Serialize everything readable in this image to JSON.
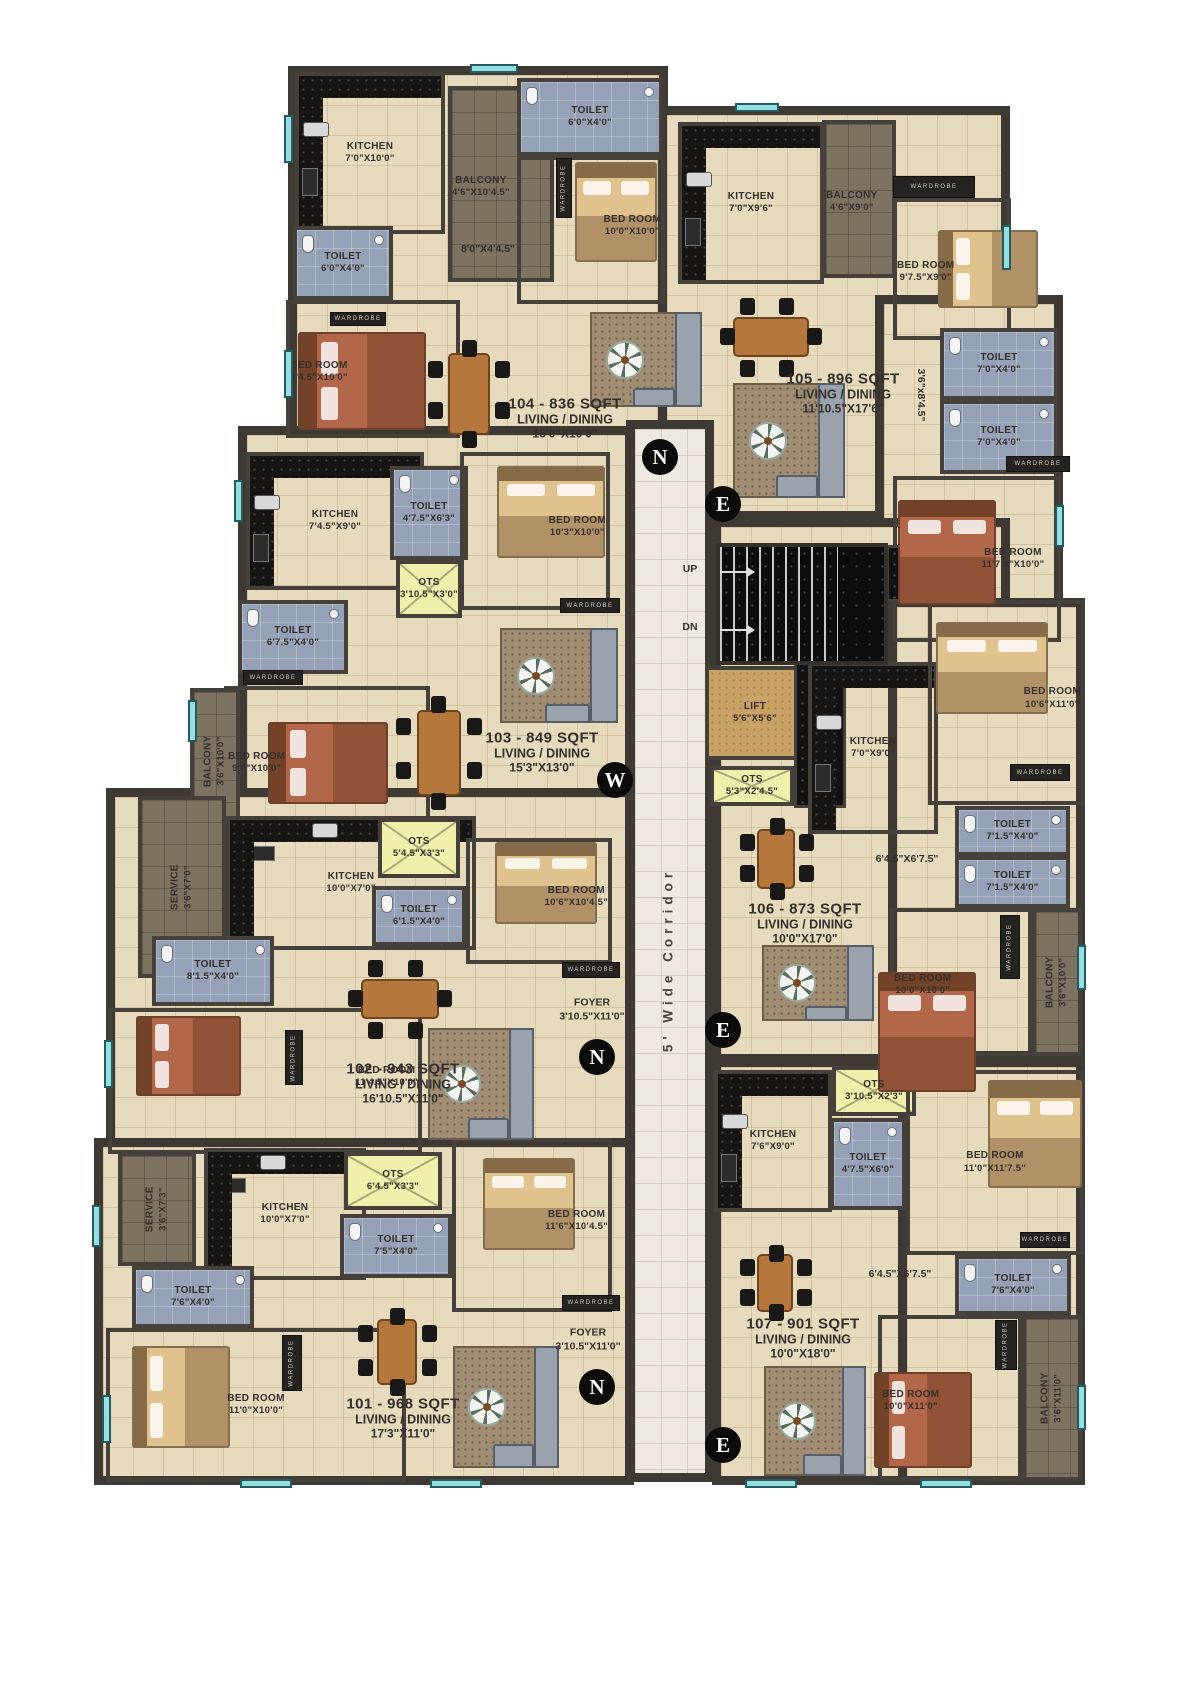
{
  "colors": {
    "wall": "#3e3933",
    "floor": "#e8dabd",
    "toilet": "#95a1b6",
    "balcony": "#7e7260",
    "ots": "#eff0ac",
    "lift": "#c9a265",
    "corridor": "#eee9e1",
    "stairs": "#0e0d0c",
    "window": "#9adde0"
  },
  "wardrobe_text": "WARDROBE",
  "corridor_label": "5' Wide Corridor",
  "regions": [
    {
      "x": 288,
      "y": 66,
      "w": 380,
      "h": 374
    },
    {
      "x": 658,
      "y": 106,
      "w": 352,
      "h": 414
    },
    {
      "x": 875,
      "y": 295,
      "w": 188,
      "h": 350
    },
    {
      "x": 238,
      "y": 426,
      "w": 396,
      "h": 412
    },
    {
      "x": 106,
      "y": 788,
      "w": 528,
      "h": 370
    },
    {
      "x": 94,
      "y": 1138,
      "w": 540,
      "h": 347
    },
    {
      "x": 712,
      "y": 518,
      "w": 298,
      "h": 545
    },
    {
      "x": 888,
      "y": 598,
      "w": 197,
      "h": 462
    },
    {
      "x": 712,
      "y": 1058,
      "w": 312,
      "h": 427
    },
    {
      "x": 898,
      "y": 1058,
      "w": 187,
      "h": 427
    }
  ],
  "corridor": {
    "x": 626,
    "y": 420,
    "w": 88,
    "h": 1062
  },
  "stairs": {
    "x": 716,
    "y": 543,
    "w": 172,
    "h": 122,
    "treads_w": 118,
    "up": "UP",
    "dn": "DN"
  },
  "rooms": [
    {
      "t": "kitchen",
      "x": 295,
      "y": 72,
      "w": 150,
      "h": 162,
      "label": "KITCHEN",
      "dims": "7'0\"X10'0\"",
      "counter": "left,top"
    },
    {
      "t": "balcony",
      "x": 448,
      "y": 86,
      "w": 106,
      "h": 196,
      "label": "BALCONY",
      "dims": "4'6\"X10'4.5\"",
      "lp": "top"
    },
    {
      "t": "toilet",
      "x": 517,
      "y": 78,
      "w": 146,
      "h": 78,
      "label": "TOILET",
      "dims": "6'0\"X4'0\""
    },
    {
      "t": "floor",
      "x": 517,
      "y": 156,
      "w": 148,
      "h": 148,
      "label": "BED ROOM",
      "dims": "10'0\"X10'0\"",
      "lp": "bottom"
    },
    {
      "t": "toilet",
      "x": 293,
      "y": 226,
      "w": 100,
      "h": 74,
      "label": "TOILET",
      "dims": "6'0\"X4'0\""
    },
    {
      "t": "floor",
      "x": 286,
      "y": 300,
      "w": 174,
      "h": 138,
      "label": "BED ROOM",
      "dims": "9'4.5\"X10'0\"",
      "lp": "top"
    },
    {
      "t": "kitchen",
      "x": 678,
      "y": 122,
      "w": 146,
      "h": 162,
      "label": "KITCHEN",
      "dims": "7'0\"X9'6\"",
      "counter": "left,top"
    },
    {
      "t": "balcony",
      "x": 822,
      "y": 120,
      "w": 74,
      "h": 158,
      "label": "BALCONY",
      "dims": "4'6\"X9'0\"",
      "lp": "top"
    },
    {
      "t": "floor",
      "x": 893,
      "y": 198,
      "w": 118,
      "h": 142,
      "label": "BED ROOM",
      "dims": "9'7.5\"X9'0\"",
      "lp": "top"
    },
    {
      "t": "toilet",
      "x": 940,
      "y": 328,
      "w": 118,
      "h": 72,
      "label": "TOILET",
      "dims": "7'0\"X4'0\""
    },
    {
      "t": "toilet",
      "x": 940,
      "y": 400,
      "w": 118,
      "h": 74,
      "label": "TOILET",
      "dims": "7'0\"X4'0\""
    },
    {
      "t": "floor",
      "x": 893,
      "y": 476,
      "w": 168,
      "h": 166,
      "label": "BED ROOM",
      "dims": "11'7.5\"X10'0\"",
      "lp": "right"
    },
    {
      "t": "lift",
      "x": 705,
      "y": 666,
      "w": 100,
      "h": 94,
      "label": "LIFT",
      "dims": "5'6\"X5'6\""
    },
    {
      "t": "ots",
      "x": 710,
      "y": 766,
      "w": 84,
      "h": 40,
      "label": "OTS",
      "dims": "5'3\"X2'4.5\""
    },
    {
      "t": "shaft",
      "x": 794,
      "y": 662,
      "w": 52,
      "h": 146
    },
    {
      "t": "shaft",
      "x": 886,
      "y": 545,
      "w": 100,
      "h": 57
    },
    {
      "t": "kitchen",
      "x": 808,
      "y": 662,
      "w": 130,
      "h": 172,
      "label": "KITCHEN",
      "dims": "7'0\"X9'0\"",
      "counter": "left,top"
    },
    {
      "t": "floor",
      "x": 928,
      "y": 600,
      "w": 157,
      "h": 205,
      "label": "BED ROOM",
      "dims": "10'6\"X11'0\"",
      "lp": "bottom"
    },
    {
      "t": "toilet",
      "x": 955,
      "y": 806,
      "w": 115,
      "h": 50,
      "label": "TOILET",
      "dims": "7'1.5\"X4'0\""
    },
    {
      "t": "toilet",
      "x": 955,
      "y": 856,
      "w": 115,
      "h": 52,
      "label": "TOILET",
      "dims": "7'1.5\"X4'0\""
    },
    {
      "t": "floor",
      "x": 890,
      "y": 908,
      "w": 142,
      "h": 148,
      "label": "BED ROOM",
      "dims": "10'0\"X10'0\"",
      "lp": "top"
    },
    {
      "t": "balcony",
      "x": 1032,
      "y": 908,
      "w": 50,
      "h": 148,
      "label": "BALCONY",
      "dims": "3'6\"X10'0\"",
      "vertical": true
    },
    {
      "t": "kitchen",
      "x": 714,
      "y": 1070,
      "w": 118,
      "h": 142,
      "label": "KITCHEN",
      "dims": "7'6\"X9'0\"",
      "counter": "left,top"
    },
    {
      "t": "ots",
      "x": 832,
      "y": 1066,
      "w": 84,
      "h": 50,
      "label": "OTS",
      "dims": "3'10.5\"X2'3\""
    },
    {
      "t": "toilet",
      "x": 830,
      "y": 1118,
      "w": 76,
      "h": 92,
      "label": "TOILET",
      "dims": "4'7.5\"X6'0\""
    },
    {
      "t": "floor",
      "x": 906,
      "y": 1070,
      "w": 178,
      "h": 185,
      "label": "BED ROOM",
      "dims": "11'0\"X11'7.5\"",
      "lp": "center"
    },
    {
      "t": "toilet",
      "x": 955,
      "y": 1255,
      "w": 116,
      "h": 60,
      "label": "TOILET",
      "dims": "7'6\"X4'0\""
    },
    {
      "t": "floor",
      "x": 878,
      "y": 1315,
      "w": 144,
      "h": 166,
      "label": "BED ROOM",
      "dims": "10'0\"X11'0\"",
      "lp": "top"
    },
    {
      "t": "balcony",
      "x": 1022,
      "y": 1315,
      "w": 60,
      "h": 166,
      "label": "BALCONY",
      "dims": "3'6\"X11'0\"",
      "vertical": true
    },
    {
      "t": "kitchen",
      "x": 246,
      "y": 452,
      "w": 178,
      "h": 138,
      "label": "KITCHEN",
      "dims": "7'4.5\"X9'0\"",
      "counter": "left,top"
    },
    {
      "t": "toilet",
      "x": 390,
      "y": 466,
      "w": 78,
      "h": 94,
      "label": "TOILET",
      "dims": "4'7.5\"X6'3\""
    },
    {
      "t": "ots",
      "x": 396,
      "y": 560,
      "w": 66,
      "h": 58,
      "label": "OTS",
      "dims": "3'10.5\"X3'0\""
    },
    {
      "t": "toilet",
      "x": 238,
      "y": 600,
      "w": 110,
      "h": 74,
      "label": "TOILET",
      "dims": "6'7.5\"X4'0\""
    },
    {
      "t": "floor",
      "x": 224,
      "y": 686,
      "w": 206,
      "h": 148,
      "label": "BED ROOM",
      "dims": "9'6\"X10'0\"",
      "lp": "top"
    },
    {
      "t": "balcony",
      "x": 190,
      "y": 688,
      "w": 50,
      "h": 146,
      "label": "BALCONY",
      "dims": "3'6\"X10'0\"",
      "vertical": true
    },
    {
      "t": "floor",
      "x": 460,
      "y": 452,
      "w": 150,
      "h": 158,
      "label": "BED ROOM",
      "dims": "10'3\"X10'0\"",
      "lp": "bottom"
    },
    {
      "t": "service",
      "x": 138,
      "y": 796,
      "w": 88,
      "h": 182,
      "label": "SERVICE",
      "dims": "3'6\"X7'0\"",
      "vertical": true
    },
    {
      "t": "kitchen",
      "x": 226,
      "y": 816,
      "w": 250,
      "h": 134,
      "label": "KITCHEN",
      "dims": "10'0\"X7'0\"",
      "counter": "top,left"
    },
    {
      "t": "ots",
      "x": 378,
      "y": 818,
      "w": 82,
      "h": 60,
      "label": "OTS",
      "dims": "5'4.5\"X3'3\""
    },
    {
      "t": "toilet",
      "x": 372,
      "y": 886,
      "w": 94,
      "h": 60,
      "label": "TOILET",
      "dims": "6'1.5\"X4'0\""
    },
    {
      "t": "toilet",
      "x": 152,
      "y": 936,
      "w": 122,
      "h": 70,
      "label": "TOILET",
      "dims": "8'1.5\"X4'0\""
    },
    {
      "t": "floor",
      "x": 108,
      "y": 1008,
      "w": 314,
      "h": 146,
      "label": "BED ROOM",
      "dims": "11'4.5\"X10'0\"",
      "lp": "bottom"
    },
    {
      "t": "floor",
      "x": 466,
      "y": 838,
      "w": 146,
      "h": 126,
      "label": "BED ROOM",
      "dims": "10'6\"X10'4.5\"",
      "lp": "bottom"
    },
    {
      "t": "service",
      "x": 118,
      "y": 1152,
      "w": 78,
      "h": 114,
      "label": "SERVICE",
      "dims": "3'6\"X7'3\"",
      "vertical": true
    },
    {
      "t": "kitchen",
      "x": 204,
      "y": 1148,
      "w": 162,
      "h": 132,
      "label": "KITCHEN",
      "dims": "10'0\"X7'0\"",
      "counter": "top,left"
    },
    {
      "t": "ots",
      "x": 344,
      "y": 1152,
      "w": 98,
      "h": 58,
      "label": "OTS",
      "dims": "6'4.5\"X3'3\""
    },
    {
      "t": "toilet",
      "x": 340,
      "y": 1214,
      "w": 112,
      "h": 64,
      "label": "TOILET",
      "dims": "7'5\"X4'0\""
    },
    {
      "t": "toilet",
      "x": 132,
      "y": 1266,
      "w": 122,
      "h": 62,
      "label": "TOILET",
      "dims": "7'6\"X4'0\""
    },
    {
      "t": "floor",
      "x": 106,
      "y": 1328,
      "w": 300,
      "h": 154,
      "label": "BED ROOM",
      "dims": "11'0\"X10'0\"",
      "lp": "center"
    },
    {
      "t": "floor",
      "x": 452,
      "y": 1138,
      "w": 160,
      "h": 174,
      "label": "BED ROOM",
      "dims": "11'6\"X10'4.5\"",
      "lp": "bottom"
    }
  ],
  "labels": [
    {
      "cls": "u",
      "x": 565,
      "y": 418,
      "lines": [
        "104 - 836 SQFT",
        "LIVING / DINING",
        "16'0\"X10'0\""
      ]
    },
    {
      "cls": "u",
      "x": 843,
      "y": 393,
      "lines": [
        "105 - 896 SQFT",
        "LIVING / DINING",
        "11'10.5\"X17'6\""
      ]
    },
    {
      "cls": "u",
      "x": 542,
      "y": 752,
      "lines": [
        "103 - 849 SQFT",
        "LIVING / DINING",
        "15'3\"X13'0\""
      ]
    },
    {
      "cls": "u",
      "x": 403,
      "y": 1083,
      "lines": [
        "102 - 943 SQFT",
        "LIVING / DINING",
        "16'10.5\"X11'0\""
      ]
    },
    {
      "cls": "u",
      "x": 403,
      "y": 1418,
      "lines": [
        "101 - 968 SQFT",
        "LIVING / DINING",
        "17'3\"X11'0\""
      ]
    },
    {
      "cls": "u",
      "x": 805,
      "y": 923,
      "lines": [
        "106 - 873 SQFT",
        "LIVING / DINING",
        "10'0\"X17'0\""
      ]
    },
    {
      "cls": "u",
      "x": 803,
      "y": 1338,
      "lines": [
        "107 - 901 SQFT",
        "LIVING / DINING",
        "10'0\"X18'0\""
      ]
    },
    {
      "cls": "d",
      "x": 592,
      "y": 1010,
      "lines": [
        "FOYER",
        "3'10.5\"X11'0\""
      ]
    },
    {
      "cls": "d",
      "x": 588,
      "y": 1340,
      "lines": [
        "FOYER",
        "3'10.5\"X11'0\""
      ]
    },
    {
      "cls": "d",
      "x": 488,
      "y": 250,
      "lines": [
        "8'0\"X4'4.5\""
      ]
    },
    {
      "cls": "d",
      "x": 907,
      "y": 860,
      "lines": [
        "6'4.5\"X6'7.5\""
      ]
    },
    {
      "cls": "d",
      "x": 900,
      "y": 1275,
      "lines": [
        "6'4.5\"X6'7.5\""
      ]
    },
    {
      "cls": "d v90",
      "x": 920,
      "y": 395,
      "lines": [
        "3'6\"x8'4.5\""
      ]
    },
    {
      "cls": "d",
      "x": 690,
      "y": 570,
      "lines": [
        "UP"
      ]
    },
    {
      "cls": "d",
      "x": 690,
      "y": 628,
      "lines": [
        "DN"
      ]
    }
  ],
  "compasses": [
    {
      "letter": "N",
      "x": 660,
      "y": 457
    },
    {
      "letter": "E",
      "x": 723,
      "y": 504
    },
    {
      "letter": "W",
      "x": 615,
      "y": 780
    },
    {
      "letter": "N",
      "x": 597,
      "y": 1057
    },
    {
      "letter": "E",
      "x": 723,
      "y": 1030
    },
    {
      "letter": "N",
      "x": 597,
      "y": 1387
    },
    {
      "letter": "E",
      "x": 723,
      "y": 1445
    }
  ],
  "wardrobes": [
    {
      "x": 556,
      "y": 158,
      "w": 16,
      "h": 60,
      "v": true
    },
    {
      "x": 330,
      "y": 312,
      "w": 56,
      "h": 14
    },
    {
      "x": 893,
      "y": 176,
      "w": 82,
      "h": 22
    },
    {
      "x": 1006,
      "y": 456,
      "w": 64,
      "h": 16
    },
    {
      "x": 1010,
      "y": 764,
      "w": 60,
      "h": 17
    },
    {
      "x": 1000,
      "y": 915,
      "w": 20,
      "h": 64,
      "v": true
    },
    {
      "x": 995,
      "y": 1320,
      "w": 22,
      "h": 50,
      "v": true
    },
    {
      "x": 562,
      "y": 1295,
      "w": 58,
      "h": 16
    },
    {
      "x": 562,
      "y": 962,
      "w": 58,
      "h": 16
    },
    {
      "x": 243,
      "y": 670,
      "w": 60,
      "h": 15
    },
    {
      "x": 560,
      "y": 598,
      "w": 60,
      "h": 15
    },
    {
      "x": 282,
      "y": 1335,
      "w": 20,
      "h": 56,
      "v": true
    },
    {
      "x": 285,
      "y": 1030,
      "w": 18,
      "h": 55,
      "v": true
    },
    {
      "x": 1020,
      "y": 1232,
      "w": 50,
      "h": 16
    }
  ],
  "furniture": [
    {
      "k": "bed",
      "v": "tan",
      "o": "v",
      "x": 575,
      "y": 162,
      "w": 82,
      "h": 100
    },
    {
      "k": "bed",
      "v": "rust",
      "o": "h",
      "x": 298,
      "y": 332,
      "w": 128,
      "h": 98
    },
    {
      "k": "bed",
      "v": "tan",
      "o": "h",
      "x": 938,
      "y": 230,
      "w": 100,
      "h": 78
    },
    {
      "k": "bed",
      "v": "rust",
      "o": "v",
      "x": 898,
      "y": 500,
      "w": 98,
      "h": 105
    },
    {
      "k": "bed",
      "v": "tan",
      "o": "v",
      "x": 936,
      "y": 622,
      "w": 112,
      "h": 92
    },
    {
      "k": "bed",
      "v": "rust",
      "o": "v",
      "x": 878,
      "y": 972,
      "w": 98,
      "h": 120
    },
    {
      "k": "bed",
      "v": "tan",
      "o": "v",
      "x": 988,
      "y": 1080,
      "w": 94,
      "h": 108
    },
    {
      "k": "bed",
      "v": "rust",
      "o": "h",
      "x": 874,
      "y": 1372,
      "w": 98,
      "h": 96
    },
    {
      "k": "bed",
      "v": "rust",
      "o": "h",
      "x": 268,
      "y": 722,
      "w": 120,
      "h": 82
    },
    {
      "k": "bed",
      "v": "tan",
      "o": "v",
      "x": 497,
      "y": 466,
      "w": 108,
      "h": 92
    },
    {
      "k": "bed",
      "v": "rust",
      "o": "h",
      "x": 136,
      "y": 1016,
      "w": 105,
      "h": 80
    },
    {
      "k": "bed",
      "v": "tan",
      "o": "v",
      "x": 495,
      "y": 842,
      "w": 102,
      "h": 82
    },
    {
      "k": "bed",
      "v": "tan",
      "o": "h",
      "x": 132,
      "y": 1346,
      "w": 98,
      "h": 102
    },
    {
      "k": "bed",
      "v": "tan",
      "o": "v",
      "x": 483,
      "y": 1158,
      "w": 92,
      "h": 92
    },
    {
      "k": "dining",
      "o": "v",
      "x": 428,
      "y": 342,
      "w": 82,
      "h": 104
    },
    {
      "k": "dining",
      "o": "h",
      "x": 722,
      "y": 298,
      "w": 98,
      "h": 78
    },
    {
      "k": "dining",
      "o": "v",
      "x": 396,
      "y": 698,
      "w": 86,
      "h": 110
    },
    {
      "k": "dining",
      "o": "h",
      "x": 350,
      "y": 960,
      "w": 100,
      "h": 78
    },
    {
      "k": "dining",
      "o": "v",
      "x": 358,
      "y": 1310,
      "w": 78,
      "h": 84
    },
    {
      "k": "dining",
      "o": "v",
      "x": 740,
      "y": 820,
      "w": 72,
      "h": 78
    },
    {
      "k": "dining",
      "o": "v",
      "x": 740,
      "y": 1246,
      "w": 70,
      "h": 74
    },
    {
      "k": "lounge",
      "x": 590,
      "y": 312,
      "w": 112,
      "h": 95
    },
    {
      "k": "lounge",
      "x": 733,
      "y": 383,
      "w": 112,
      "h": 115
    },
    {
      "k": "lounge",
      "x": 500,
      "y": 628,
      "w": 118,
      "h": 95
    },
    {
      "k": "lounge",
      "x": 428,
      "y": 1028,
      "w": 106,
      "h": 112
    },
    {
      "k": "lounge",
      "x": 453,
      "y": 1346,
      "w": 106,
      "h": 122
    },
    {
      "k": "lounge",
      "x": 762,
      "y": 945,
      "w": 112,
      "h": 76
    },
    {
      "k": "lounge",
      "x": 764,
      "y": 1366,
      "w": 102,
      "h": 110
    }
  ],
  "windows": [
    {
      "x": 284,
      "y": 115,
      "w": 9,
      "h": 48
    },
    {
      "x": 284,
      "y": 350,
      "w": 9,
      "h": 48
    },
    {
      "x": 234,
      "y": 480,
      "w": 9,
      "h": 42
    },
    {
      "x": 188,
      "y": 700,
      "w": 9,
      "h": 42
    },
    {
      "x": 104,
      "y": 1040,
      "w": 9,
      "h": 48
    },
    {
      "x": 92,
      "y": 1205,
      "w": 9,
      "h": 42
    },
    {
      "x": 102,
      "y": 1395,
      "w": 9,
      "h": 48
    },
    {
      "x": 240,
      "y": 1479,
      "w": 52,
      "h": 9
    },
    {
      "x": 430,
      "y": 1479,
      "w": 52,
      "h": 9
    },
    {
      "x": 745,
      "y": 1479,
      "w": 52,
      "h": 9
    },
    {
      "x": 920,
      "y": 1479,
      "w": 52,
      "h": 9
    },
    {
      "x": 1002,
      "y": 225,
      "w": 9,
      "h": 45
    },
    {
      "x": 1055,
      "y": 505,
      "w": 9,
      "h": 42
    },
    {
      "x": 1077,
      "y": 945,
      "w": 9,
      "h": 45
    },
    {
      "x": 1077,
      "y": 1385,
      "w": 9,
      "h": 45
    },
    {
      "x": 470,
      "y": 64,
      "w": 48,
      "h": 9
    },
    {
      "x": 735,
      "y": 103,
      "w": 44,
      "h": 9
    }
  ]
}
